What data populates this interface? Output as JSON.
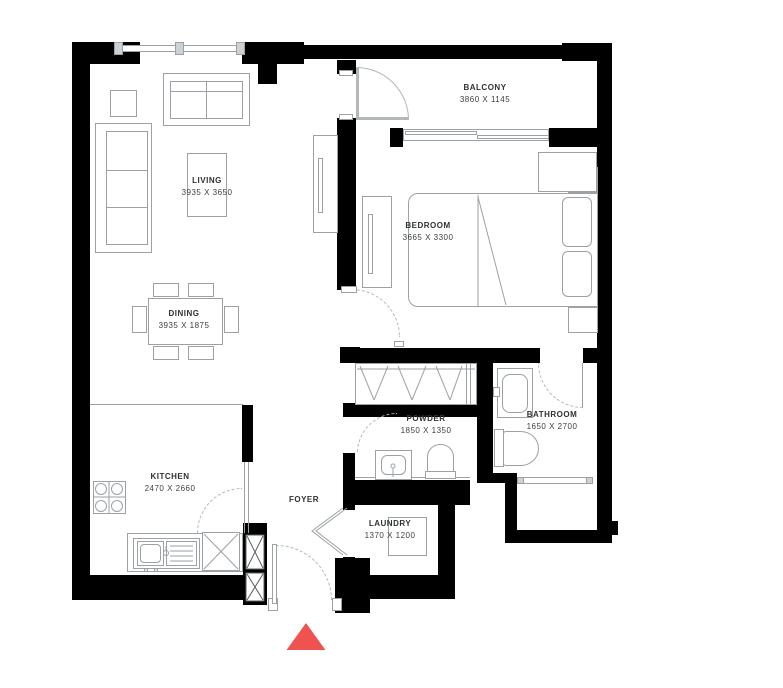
{
  "plan": {
    "type": "apartment-floor-plan",
    "wall_color": "#000000",
    "line_color": "#9ba1a4",
    "entry_marker_color": "#ef5350",
    "background_color": "#ffffff"
  },
  "rooms": {
    "living": {
      "name": "LIVING",
      "dims": "3935 X 3650"
    },
    "dining": {
      "name": "DINING",
      "dims": "3935 X 1875"
    },
    "balcony": {
      "name": "BALCONY",
      "dims": "3860 X 1145"
    },
    "bedroom": {
      "name": "BEDROOM",
      "dims": "3665 X 3300"
    },
    "kitchen": {
      "name": "KITCHEN",
      "dims": "2470 X 2660"
    },
    "powder": {
      "name": "POWDER",
      "dims": "1850 X 1350"
    },
    "bathroom": {
      "name": "BATHROOM",
      "dims": "1650 X 2700"
    },
    "foyer": {
      "name": "FOYER",
      "dims": ""
    },
    "laundry": {
      "name": "LAUNDRY",
      "dims": "1370 X 1200"
    }
  }
}
